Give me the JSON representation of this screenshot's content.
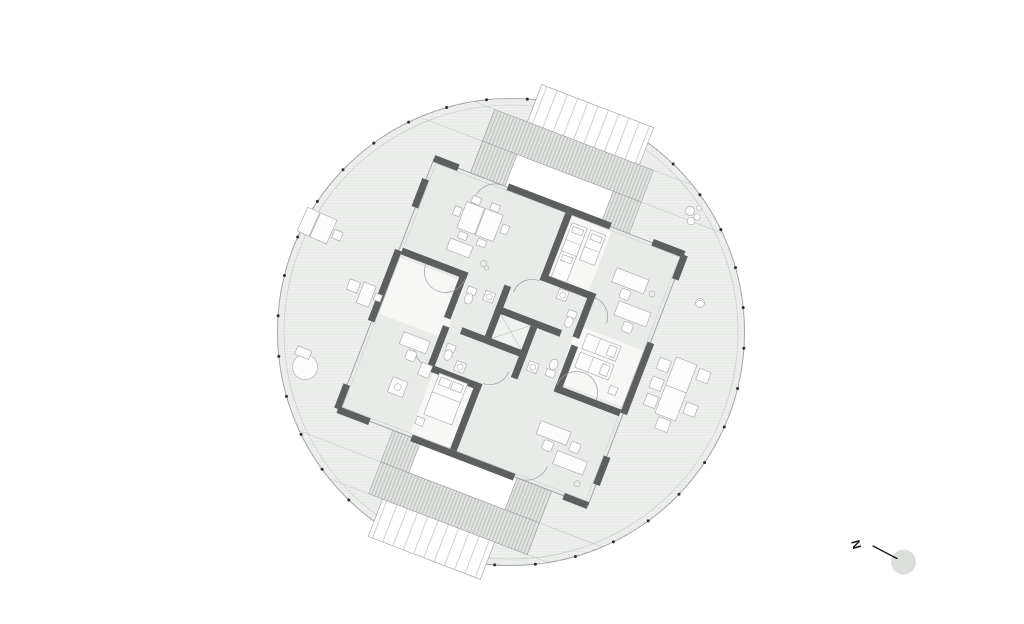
{
  "plan": {
    "type": "circular floor plan",
    "north_label": "N",
    "perimeter_dots": 36,
    "apartments": 4,
    "ramps": 2
  },
  "icons": [
    "bed-icon",
    "double-bed-icon",
    "desk-icon",
    "chair-icon",
    "dining-table-icon",
    "sofa-icon",
    "lounge-chair-icon",
    "round-table-icon",
    "plant-icon",
    "toilet-icon",
    "sink-icon",
    "north-arrow-icon"
  ],
  "colors": {
    "background": "#ffffff",
    "deck": "#eef0ee",
    "plank": "#e2e4e2",
    "ring": "#9aa09d",
    "ring_light": "#c4c8c4",
    "floor": "#e9ebe9",
    "room_white": "#f7f8f6",
    "shaft": "#f0f2f0",
    "wall": "#5b5f5d",
    "line": "#9aa09d",
    "line_mid": "#aeb2ae",
    "line_light": "#c2c6c2",
    "band": "#e0e2e0",
    "tread": "#a2a6a2",
    "landing": "#ffffff",
    "furniture": "#fdfdfd",
    "dot": "#2e2e2e",
    "north": "#141414",
    "north_disc": "#dcdedc"
  }
}
